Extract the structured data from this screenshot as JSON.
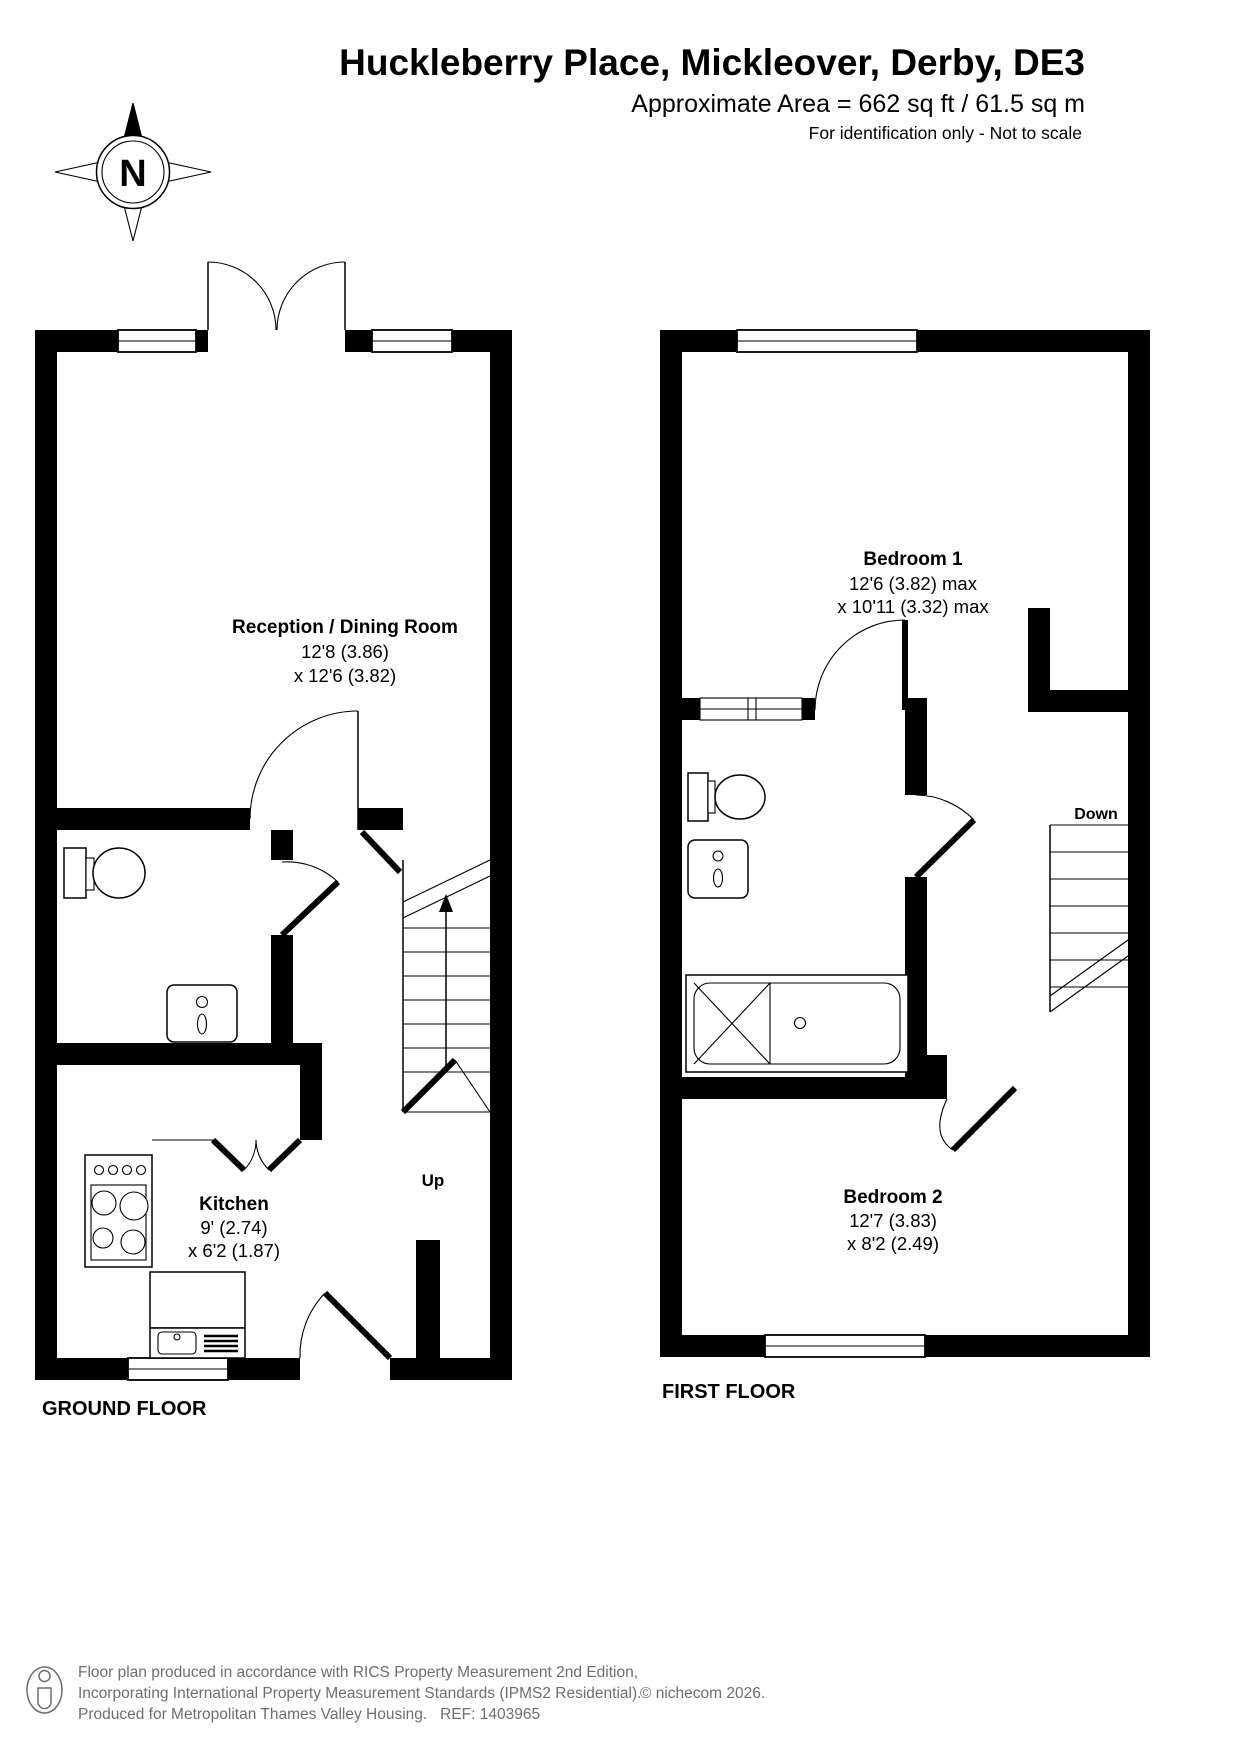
{
  "header": {
    "title": "Huckleberry Place, Mickleover, Derby, DE3",
    "area": "Approximate Area = 662 sq ft / 61.5 sq m",
    "disclaimer": "For identification only - Not to scale"
  },
  "compass": {
    "north_label": "N"
  },
  "ground_floor": {
    "label": "GROUND FLOOR",
    "stairs_label": "Up",
    "rooms": [
      {
        "name": "Reception / Dining Room",
        "dim1": "12'8 (3.86)",
        "dim2": "x 12'6 (3.82)"
      },
      {
        "name": "Kitchen",
        "dim1": "9' (2.74)",
        "dim2": "x 6'2 (1.87)"
      }
    ]
  },
  "first_floor": {
    "label": "FIRST FLOOR",
    "stairs_label": "Down",
    "rooms": [
      {
        "name": "Bedroom 1",
        "dim1": "12'6 (3.82) max",
        "dim2": "x 10'11 (3.32) max"
      },
      {
        "name": "Bedroom 2",
        "dim1": "12'7 (3.83)",
        "dim2": "x 8'2 (2.49)"
      }
    ]
  },
  "footer": {
    "line1": "Floor plan produced in accordance with RICS Property Measurement 2nd Edition,",
    "line2": "Incorporating International Property Measurement Standards (IPMS2 Residential).",
    "copyright": "© nichecom 2026.",
    "line3": "Produced for Metropolitan Thames Valley Housing.   REF: 1403965"
  },
  "colors": {
    "wall": "#000000",
    "footer_text": "#6e6e6e"
  }
}
